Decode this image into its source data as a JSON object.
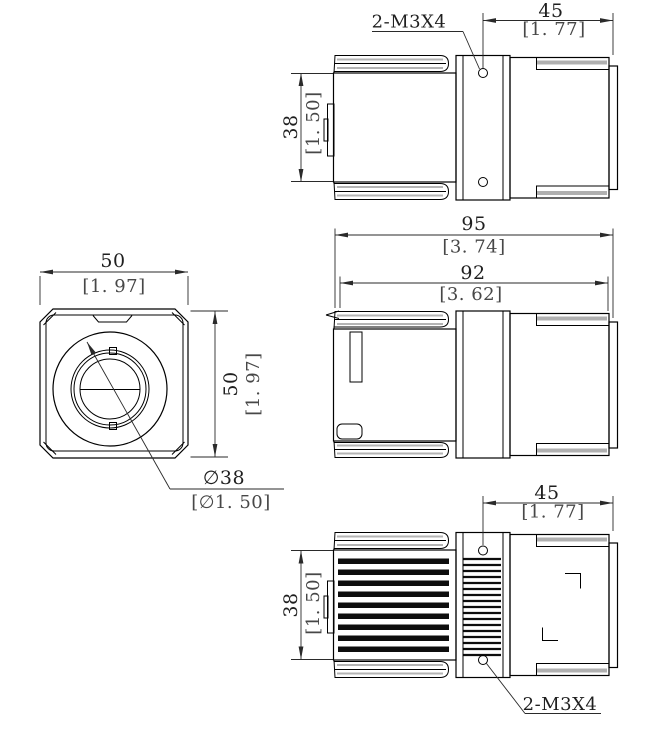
{
  "drawing": {
    "kind": "engineering-dimension-drawing",
    "colors": {
      "line": "#000000",
      "shade": "#b0b0b0",
      "dim_line": "#2a2a2a",
      "dim_text": "#1f1f1f",
      "alt_text": "#474747"
    },
    "views": {
      "top": {
        "label": "top-side-view",
        "thread_callout": "2-M3X4",
        "dims": {
          "rear_length": {
            "mm": "45",
            "in": "[1. 77]"
          },
          "height": {
            "mm": "38",
            "in": "[1. 50]"
          }
        }
      },
      "middle": {
        "label": "overall-side-view",
        "dims": {
          "overall_length": {
            "mm": "95",
            "in": "[3. 74]"
          },
          "body_length": {
            "mm": "92",
            "in": "[3. 62]"
          }
        }
      },
      "front": {
        "label": "front-view",
        "dims": {
          "width": {
            "mm": "50",
            "in": "[1. 97]"
          },
          "height": {
            "mm": "50",
            "in": "[1. 97]"
          },
          "lens_dia": {
            "mm": "∅38",
            "in": "[∅1. 50]"
          }
        }
      },
      "bottom": {
        "label": "bottom-side-view",
        "thread_callout": "2-M3X4",
        "dims": {
          "rear_length": {
            "mm": "45",
            "in": "[1. 77]"
          },
          "height": {
            "mm": "38",
            "in": "[1. 50]"
          }
        }
      }
    }
  }
}
